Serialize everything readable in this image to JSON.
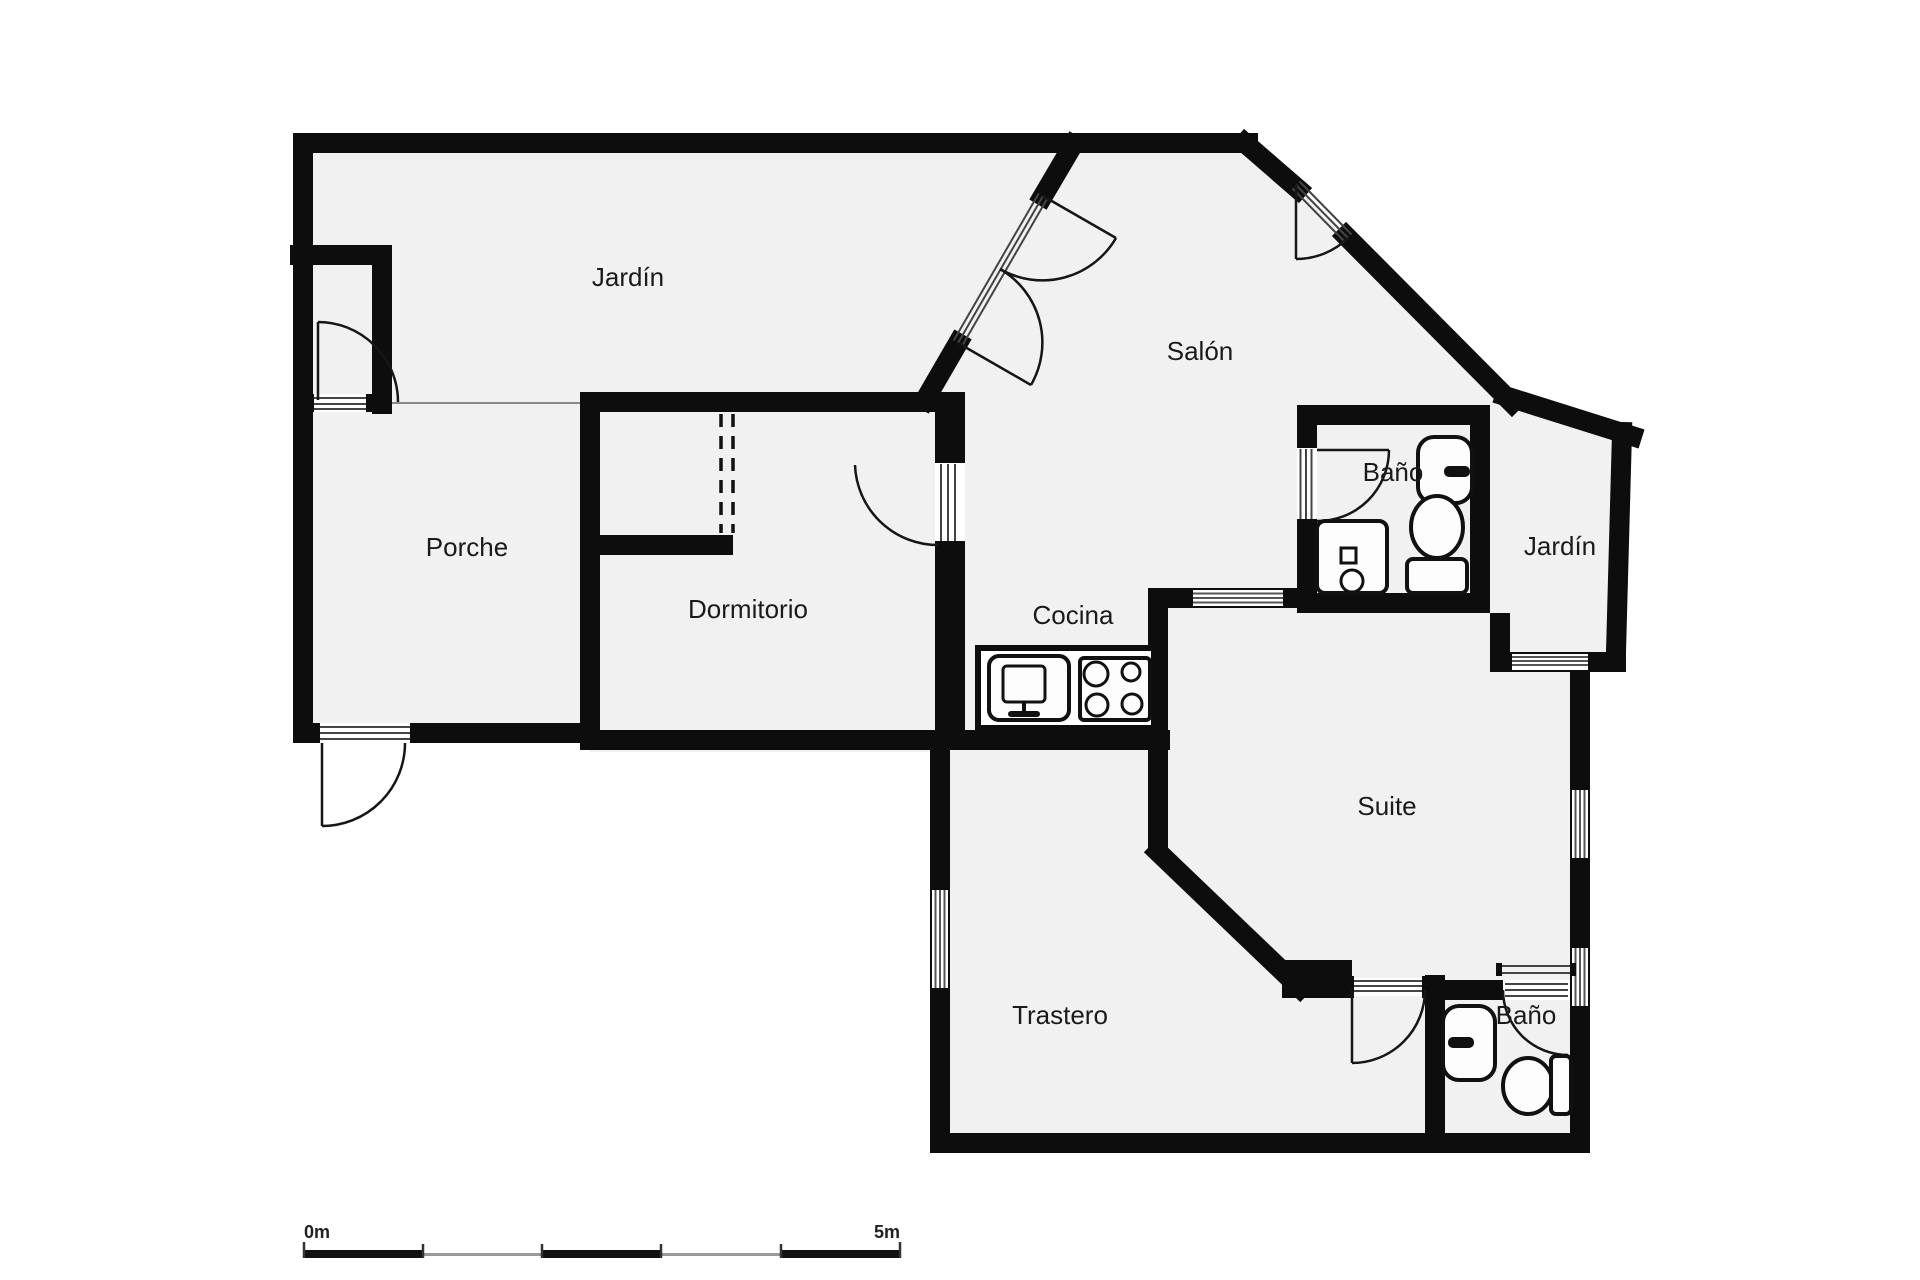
{
  "plan": {
    "type": "floor-plan",
    "rooms": [
      {
        "name": "jardin-top",
        "label": "Jardín"
      },
      {
        "name": "salon",
        "label": "Salón"
      },
      {
        "name": "bano-top",
        "label": "Baño"
      },
      {
        "name": "jardin-right",
        "label": "Jardín"
      },
      {
        "name": "porche",
        "label": "Porche"
      },
      {
        "name": "dormitorio",
        "label": "Dormitorio"
      },
      {
        "name": "cocina",
        "label": "Cocina"
      },
      {
        "name": "suite",
        "label": "Suite"
      },
      {
        "name": "trastero",
        "label": "Trastero"
      },
      {
        "name": "bano-bottom",
        "label": "Baño"
      }
    ],
    "fixtures": [
      "sink",
      "toilet",
      "washing-machine",
      "kitchen-sink",
      "stove",
      "sink",
      "toilet"
    ],
    "doors_count": 8,
    "windows_count": 5,
    "closet": {
      "type": "wardrobe-dashed",
      "room": "dormitorio"
    },
    "scale_bar": {
      "start_label": "0m",
      "end_label": "5m",
      "segments": 5
    },
    "colors": {
      "wall": "#0d0d0d",
      "floor": "#f1f1f1",
      "background": "#ffffff",
      "window_line": "#555555",
      "separator": "#888888",
      "scale_gray": "#999999",
      "text": "#1a1a1a"
    }
  }
}
